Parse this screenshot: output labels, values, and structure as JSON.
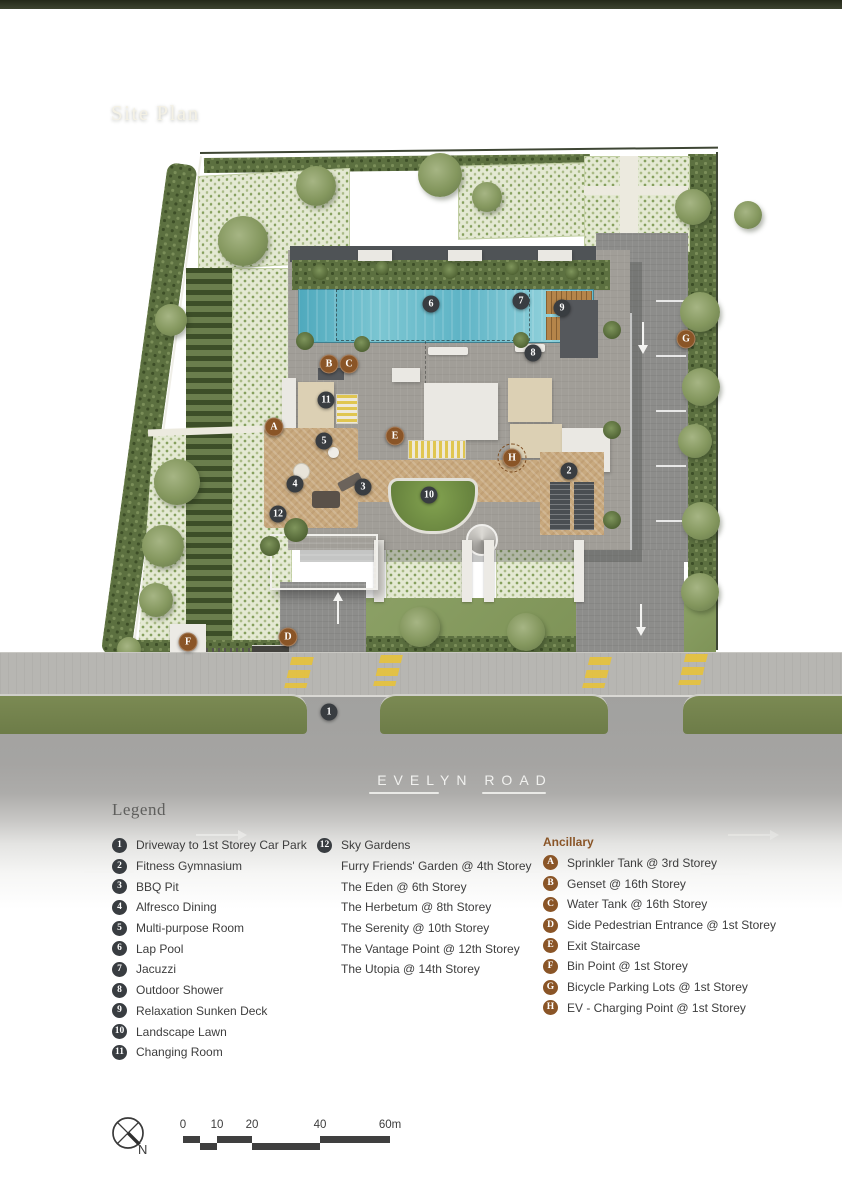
{
  "page": {
    "title": "Site Plan"
  },
  "road": {
    "name": "EVELYN ROAD"
  },
  "legend": {
    "heading": "Legend",
    "column1": [
      {
        "badge": "1",
        "label": "Driveway to 1st Storey Car Park"
      },
      {
        "badge": "2",
        "label": "Fitness Gymnasium"
      },
      {
        "badge": "3",
        "label": "BBQ Pit"
      },
      {
        "badge": "4",
        "label": "Alfresco Dining"
      },
      {
        "badge": "5",
        "label": "Multi-purpose Room"
      },
      {
        "badge": "6",
        "label": "Lap Pool"
      },
      {
        "badge": "7",
        "label": "Jacuzzi"
      },
      {
        "badge": "8",
        "label": "Outdoor Shower"
      },
      {
        "badge": "9",
        "label": "Relaxation Sunken Deck"
      },
      {
        "badge": "10",
        "label": "Landscape Lawn"
      },
      {
        "badge": "11",
        "label": "Changing Room"
      }
    ],
    "column2": {
      "badge": "12",
      "label": "Sky Gardens",
      "sub_items": [
        "Furry Friends' Garden @ 4th Storey",
        "The Eden @ 6th Storey",
        "The Herbetum @ 8th Storey",
        "The Serenity @ 10th Storey",
        "The Vantage Point @ 12th Storey",
        "The Utopia @ 14th Storey"
      ]
    },
    "ancillary": {
      "heading": "Ancillary",
      "items": [
        {
          "badge": "A",
          "label": "Sprinkler Tank @ 3rd Storey"
        },
        {
          "badge": "B",
          "label": "Genset @ 16th Storey"
        },
        {
          "badge": "C",
          "label": "Water Tank @ 16th Storey"
        },
        {
          "badge": "D",
          "label": "Side Pedestrian Entrance @ 1st Storey"
        },
        {
          "badge": "E",
          "label": "Exit Staircase"
        },
        {
          "badge": "F",
          "label": "Bin Point @ 1st Storey"
        },
        {
          "badge": "G",
          "label": "Bicycle Parking Lots @ 1st Storey"
        },
        {
          "badge": "H",
          "label": "EV - Charging Point @ 1st Storey"
        }
      ]
    }
  },
  "plan_markers": [
    {
      "id": "1",
      "kind": "number",
      "x": 329,
      "y": 712
    },
    {
      "id": "2",
      "kind": "number",
      "x": 569,
      "y": 471
    },
    {
      "id": "3",
      "kind": "number",
      "x": 363,
      "y": 487
    },
    {
      "id": "4",
      "kind": "number",
      "x": 295,
      "y": 484
    },
    {
      "id": "5",
      "kind": "number",
      "x": 324,
      "y": 441
    },
    {
      "id": "6",
      "kind": "number",
      "x": 431,
      "y": 304
    },
    {
      "id": "7",
      "kind": "number",
      "x": 521,
      "y": 301
    },
    {
      "id": "8",
      "kind": "number",
      "x": 533,
      "y": 353
    },
    {
      "id": "9",
      "kind": "number",
      "x": 562,
      "y": 308
    },
    {
      "id": "10",
      "kind": "number",
      "x": 429,
      "y": 495
    },
    {
      "id": "11",
      "kind": "number",
      "x": 326,
      "y": 400
    },
    {
      "id": "12",
      "kind": "number",
      "x": 278,
      "y": 514
    },
    {
      "id": "A",
      "kind": "letter",
      "x": 274,
      "y": 427
    },
    {
      "id": "B",
      "kind": "letter",
      "x": 329,
      "y": 364
    },
    {
      "id": "C",
      "kind": "letter",
      "x": 349,
      "y": 364
    },
    {
      "id": "D",
      "kind": "letter",
      "x": 288,
      "y": 637
    },
    {
      "id": "E",
      "kind": "letter",
      "x": 395,
      "y": 436
    },
    {
      "id": "F",
      "kind": "letter",
      "x": 188,
      "y": 642
    },
    {
      "id": "G",
      "kind": "letter",
      "x": 686,
      "y": 339
    },
    {
      "id": "H",
      "kind": "letter",
      "x": 512,
      "y": 458,
      "ring": true
    }
  ],
  "scale_bar": {
    "tick_labels": [
      "0",
      "10",
      "20",
      "40",
      "60m"
    ]
  },
  "compass": {
    "north_label": "N"
  },
  "colors": {
    "badge_number": "#393d41",
    "badge_letter": "#8a5527",
    "ancillary_heading": "#8a5527",
    "pool_blue": "#5fb4c6",
    "deck_tan": "#c8a97e",
    "crosswalk_yellow": "#e6c23c",
    "terrain_green": "#9aa084"
  }
}
